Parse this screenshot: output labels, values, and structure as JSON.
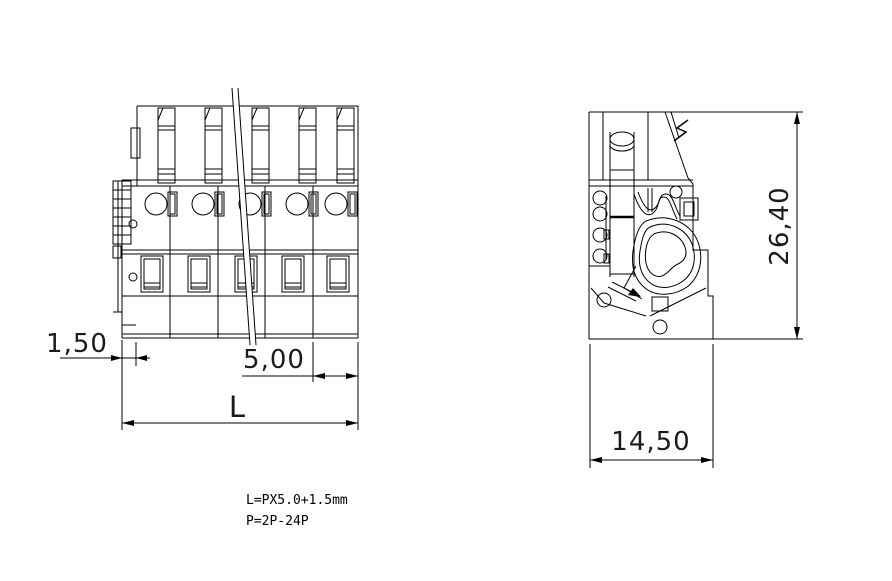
{
  "dimensions": {
    "end_margin": "1,50",
    "pitch": "5,00",
    "length": "L",
    "height": "26,40",
    "depth": "14,50"
  },
  "notes": [
    "L=PX5.0+1.5mm",
    "P=2P-24P"
  ],
  "colors": {
    "line": "#000000",
    "background": "#ffffff",
    "highlight": "#cc0000",
    "faint": "#b3b3b3"
  }
}
